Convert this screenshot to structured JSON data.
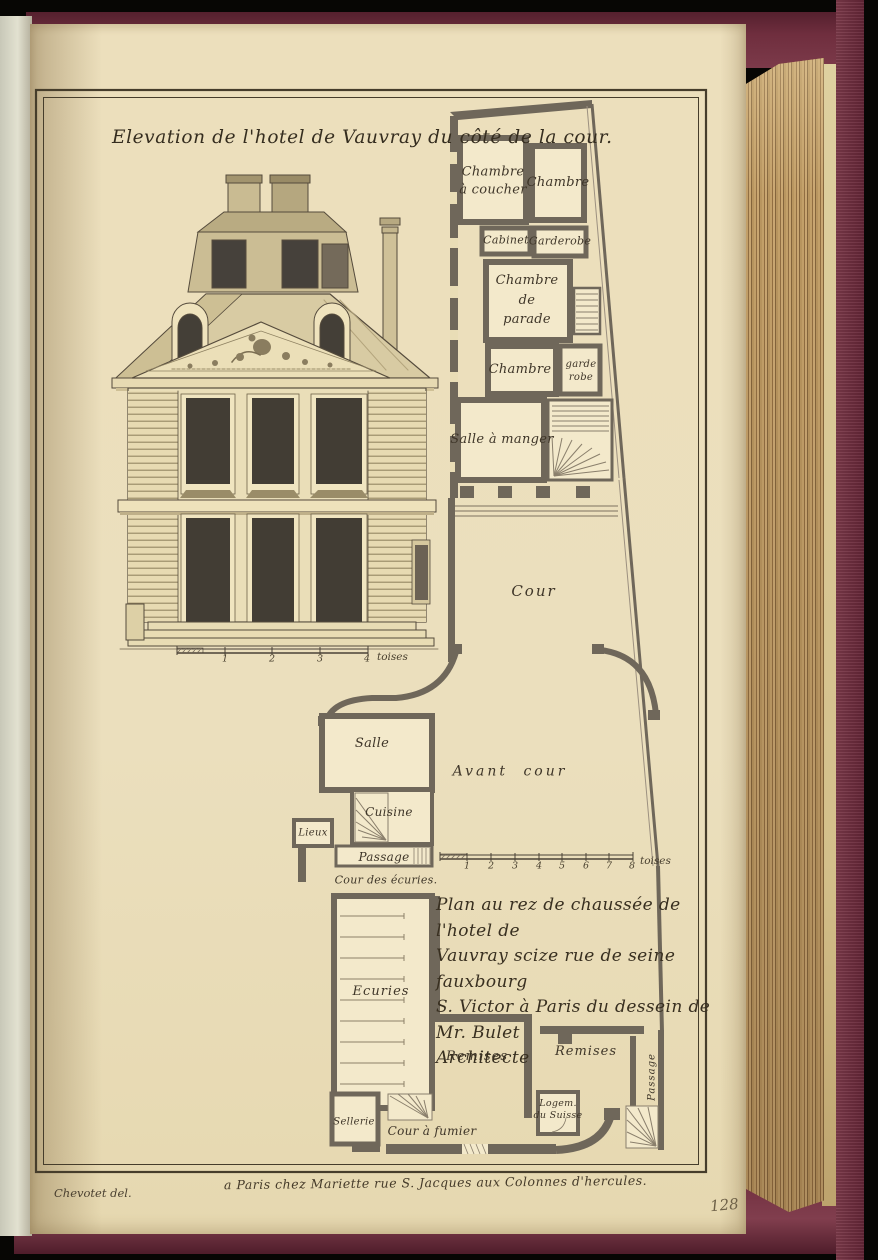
{
  "book": {
    "page_number_handwritten": "128"
  },
  "plate": {
    "title": "Elevation de l'hotel de Vauvray du côté de la cour.",
    "caption": "Plan au rez de chaussée de l'hotel de\nVauvray scize rue de seine fauxbourg\nS. Victor à Paris du dessein de Mr. Bulet\nArchitecte",
    "credit": "Chevotet del.",
    "imprint": "a Paris chez Mariette rue S. Jacques aux Colonnes d'hercules."
  },
  "labels": {
    "chambre_a_coucher": "Chambre\nà coucher",
    "chambre_1": "Chambre",
    "cabinet": "Cabinet",
    "garderobe": "Garderobe",
    "chambre_de_parade": "Chambre\nde\nparade",
    "chambre_2": "Chambre",
    "garde_robe": "garde\nrobe",
    "salle_a_manger": "Salle à manger",
    "cour": "Cour",
    "salle": "Salle",
    "cuisine": "Cuisine",
    "lieux": "Lieux",
    "passage": "Passage",
    "cour_des_ecuries": "Cour des écuries.",
    "avant_cour": "Avant cour",
    "ecuries": "Ecuries",
    "remises_left": "Remises",
    "remises_right": "Remises",
    "sellerie": "Sellerie",
    "cour_a_fumier": "Cour à fumier",
    "logement_du_suisse": "Logem.\ndu Suisse",
    "passage_vertical": "Passage"
  },
  "scales": {
    "s1": {
      "ticks": [
        "1",
        "2",
        "3",
        "4"
      ],
      "unit": "toises"
    },
    "s2": {
      "ticks": [
        "1",
        "2",
        "3",
        "4",
        "5",
        "6",
        "7",
        "8"
      ],
      "unit": "toises"
    }
  },
  "colors": {
    "binding_maroon": "#6f2e3e",
    "page_cream": "#ebdfbd",
    "fore_edge_tan": "#b08a55",
    "engraving_ink": "#554b3c",
    "plan_wall": "#6f675a"
  }
}
